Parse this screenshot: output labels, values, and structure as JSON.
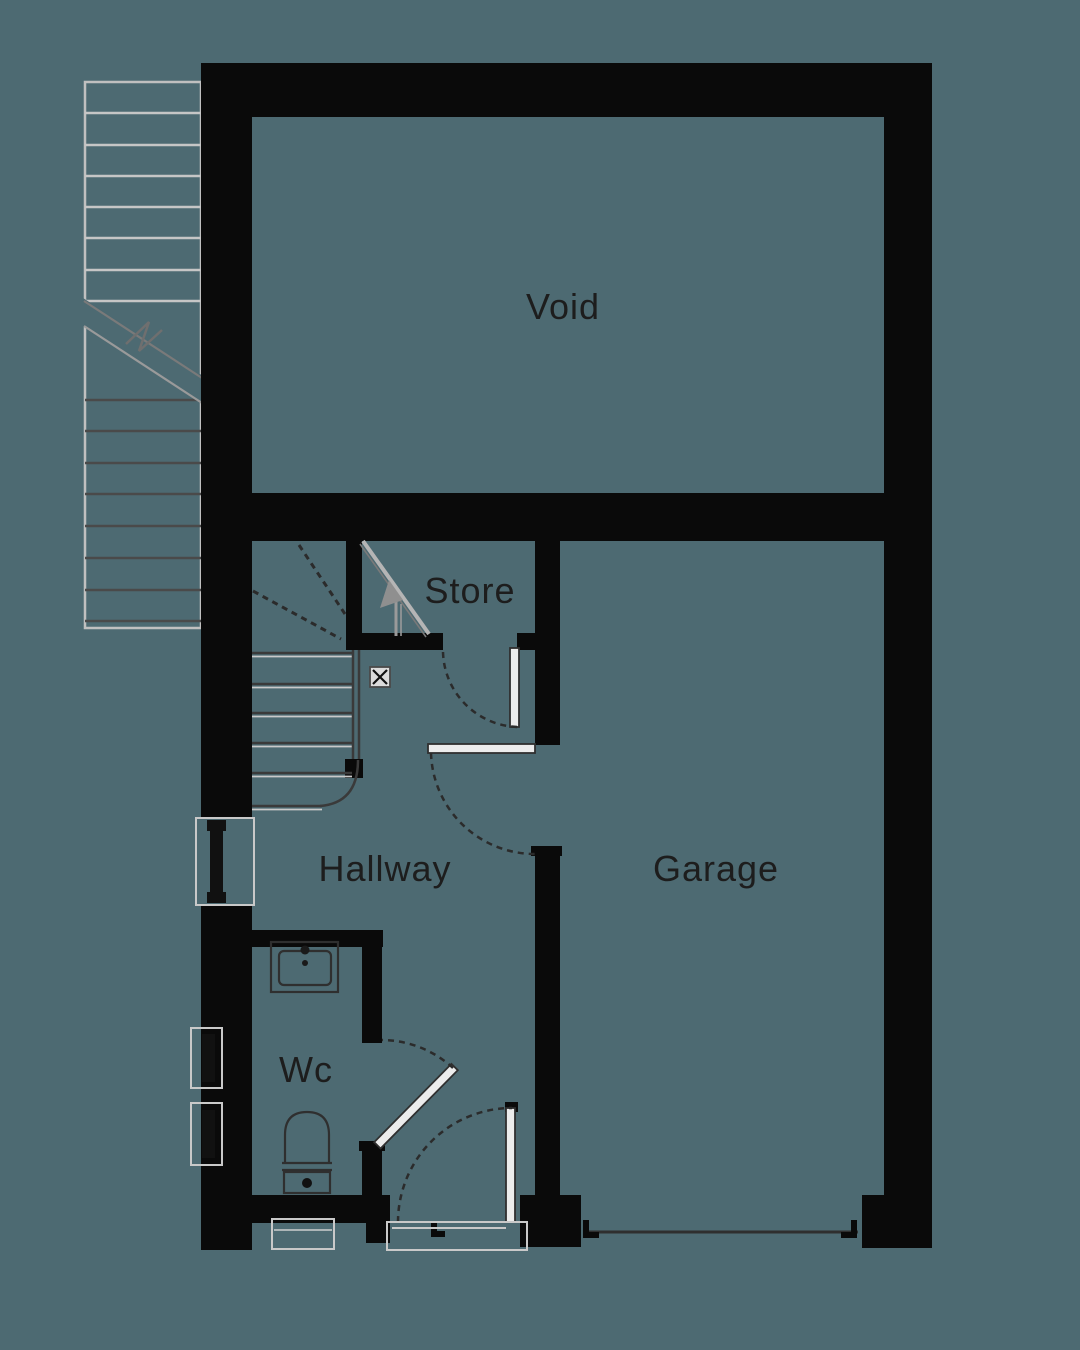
{
  "plan": {
    "title": "ground-floor-plan",
    "colors": {
      "background": "#4d6a72",
      "wall": "#0a0a0a",
      "dark_line": "#3a3a3a",
      "light_line": "#c9c9c9",
      "label_text": "#1d1d1d"
    },
    "labels": {
      "void": {
        "text": "Void"
      },
      "store": {
        "text": "Store"
      },
      "hallway": {
        "text": "Hallway"
      },
      "garage": {
        "text": "Garage"
      },
      "wc": {
        "text": "Wc"
      }
    }
  }
}
